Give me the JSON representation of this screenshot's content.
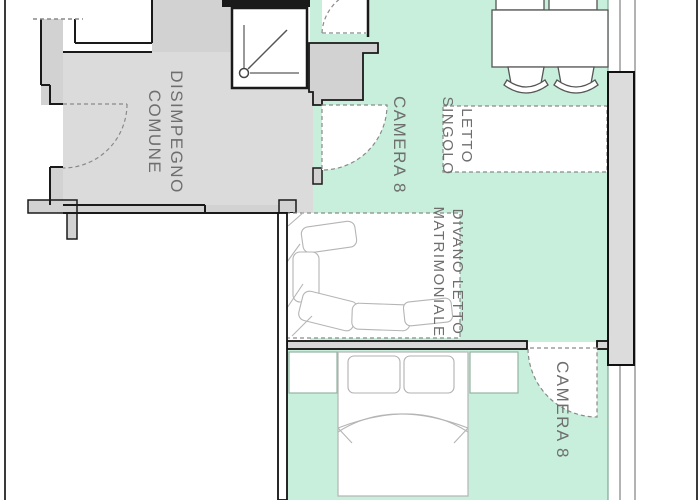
{
  "plan_title": "Apartment floor plan",
  "rooms": {
    "hallway": {
      "line1": "DISIMPEGNO",
      "line2": "COMUNE"
    },
    "camera8_upper": {
      "label": "CAMERA 8"
    },
    "camera8_lower": {
      "label": "CAMERA 8"
    }
  },
  "furniture": {
    "single_bed": {
      "line1": "LETTO",
      "line2": "SINGOLO"
    },
    "sofa_bed": {
      "line1": "DIVANO LETTO",
      "line2": "MATRIMONIALE"
    }
  },
  "colors": {
    "floor_green": "#c7efdc",
    "hallway_gray": "#dbdbdb",
    "wall_gray": "#d2d2d2",
    "wall_line": "#1a1a1a",
    "dashed_line": "#8a8a8a",
    "label_text": "#6e6e6e",
    "furniture_stroke": "#b5b5b5"
  }
}
